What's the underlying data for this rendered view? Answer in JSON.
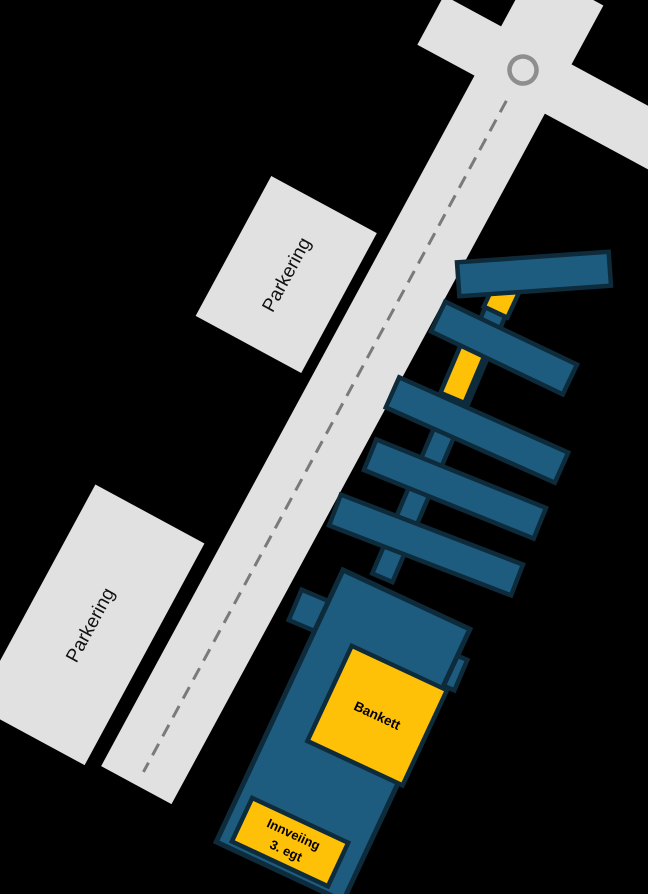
{
  "map": {
    "colors": {
      "background": "#000000",
      "road": "#e1e1e1",
      "parking": "#e1e1e1",
      "road_centerline": "#7a7a7a",
      "roundabout_ring": "#8e8e8e",
      "pier_fill": "#1d5c7e",
      "pier_border": "#0e2b3c",
      "highlight": "#ffc107",
      "parking_text": "#111111",
      "highlight_text": "#000000"
    },
    "icons": {
      "roundabout": "circle-ring"
    },
    "labels": {
      "parking_upper": "Parkering",
      "parking_lower": "Parkering",
      "banquet": "Bankett",
      "weigh_in_line1": "Innveiing",
      "weigh_in_line2": "3. egt"
    }
  }
}
